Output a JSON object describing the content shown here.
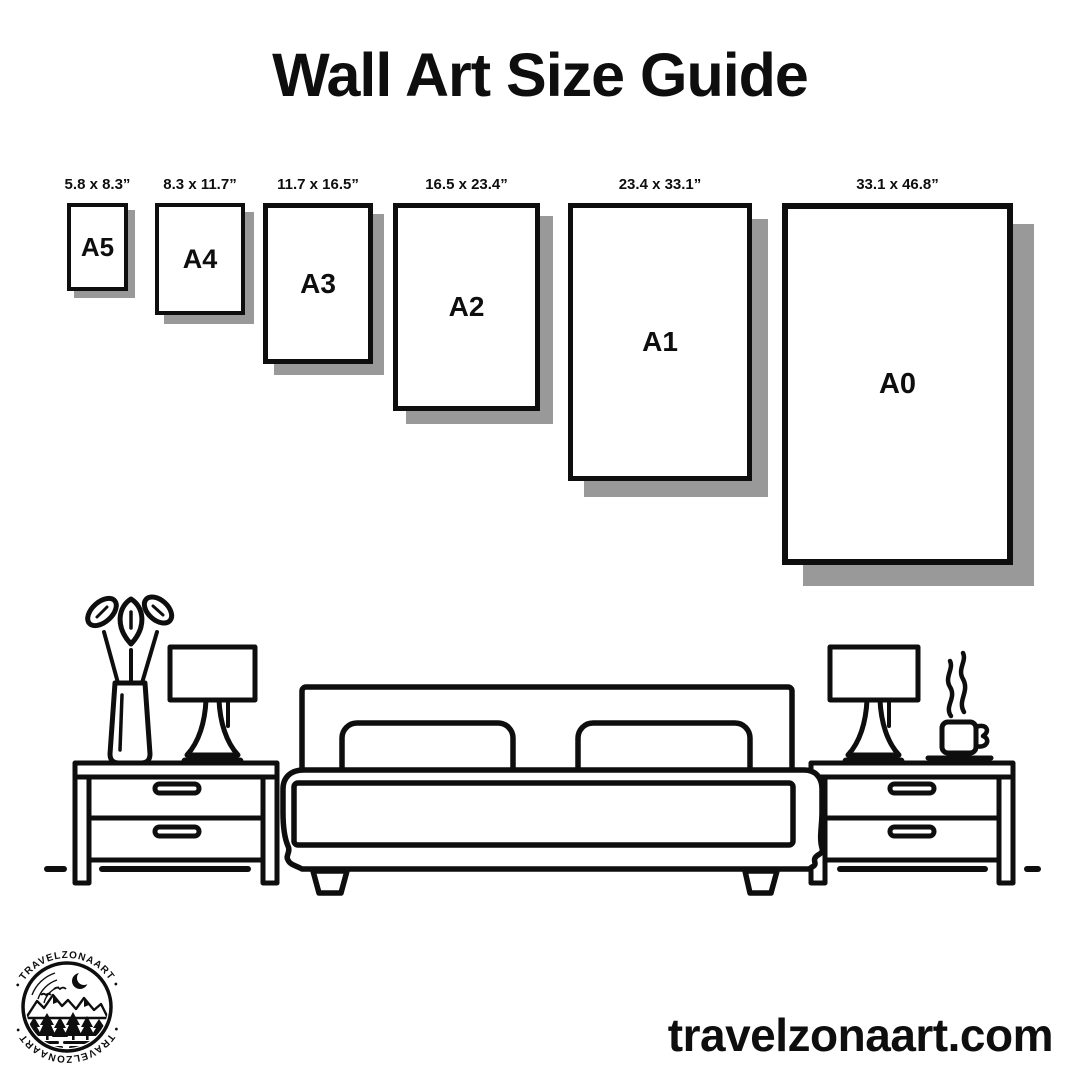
{
  "title": "Wall Art Size Guide",
  "colors": {
    "ink": "#0e0e0e",
    "shadow": "#999999",
    "background": "#ffffff"
  },
  "size_guide": {
    "items": [
      {
        "label": "A5",
        "dimensions": "5.8 x 8.3”"
      },
      {
        "label": "A4",
        "dimensions": "8.3 x 11.7”"
      },
      {
        "label": "A3",
        "dimensions": "11.7 x 16.5”"
      },
      {
        "label": "A2",
        "dimensions": "16.5 x 23.4”"
      },
      {
        "label": "A1",
        "dimensions": "23.4 x 33.1”"
      },
      {
        "label": "A0",
        "dimensions": "33.1 x 46.8”"
      }
    ]
  },
  "illustration": {
    "description": "line-art bedroom scene: bed with two pillows, two nightstands with drawers, two table lamps, vase with plant, steaming coffee cup"
  },
  "logo": {
    "top_text": "• TRAVELZONAART •",
    "bottom_text": "• TRAVELZONAART •"
  },
  "footer": {
    "website": "travelzonaart.com"
  }
}
